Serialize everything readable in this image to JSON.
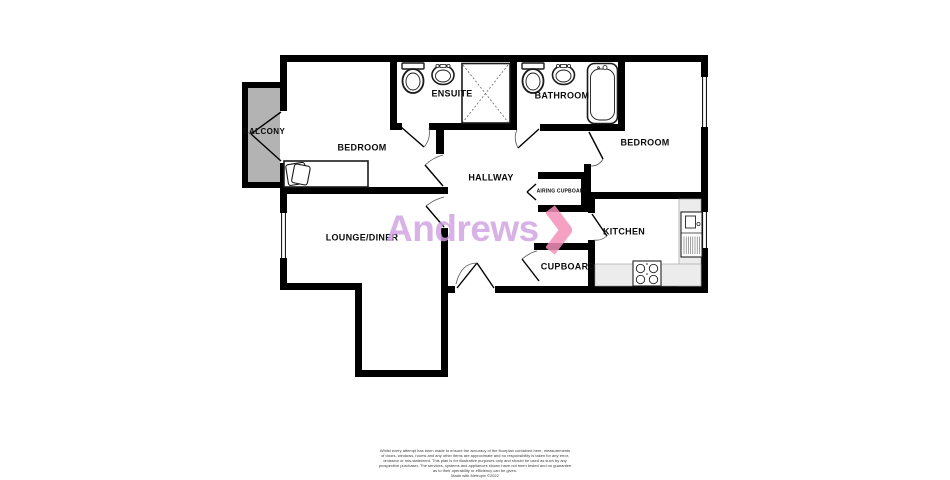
{
  "floorplan": {
    "rooms": {
      "balcony": {
        "label": "BALCONY"
      },
      "bedroom1": {
        "label": "BEDROOM"
      },
      "ensuite": {
        "label": "ENSUITE"
      },
      "bathroom": {
        "label": "BATHROOM"
      },
      "bedroom2": {
        "label": "BEDROOM"
      },
      "hallway": {
        "label": "HALLWAY"
      },
      "airing_cupboard": {
        "label": "AIRING CUPBOARD"
      },
      "lounge_diner": {
        "label": "LOUNGE/DINER"
      },
      "kitchen": {
        "label": "KITCHEN"
      },
      "cupboard": {
        "label": "CUPBOARD"
      }
    },
    "fixtures": [
      "toilet-icon",
      "basin-icon",
      "shower-icon",
      "bathtub-icon",
      "bed-icon",
      "kitchen-sink-icon",
      "hob-icon",
      "window",
      "door-swing"
    ],
    "colors": {
      "wall": "#000000",
      "balcony_fill": "#b3b3b3",
      "counter_fill": "#ececec",
      "floor_fill": "#ffffff"
    }
  },
  "branding": {
    "logo_text": "Andrews",
    "logo_color": "#cfa0e0",
    "chevron_color": "#f390ba"
  },
  "disclaimer": {
    "lines": [
      "Whilst every attempt has been made to ensure the accuracy of the floorplan contained here, measurements",
      "of doors, windows, rooms and any other items are approximate and no responsibility is taken for any error,",
      "omission or mis-statement. This plan is for illustrative purposes only and should be used as such by any",
      "prospective purchaser. The services, systems and appliances shown have not been tested and no guarantee",
      "as to their operability or efficiency can be given.",
      "Made with Metropix ©2022"
    ]
  }
}
